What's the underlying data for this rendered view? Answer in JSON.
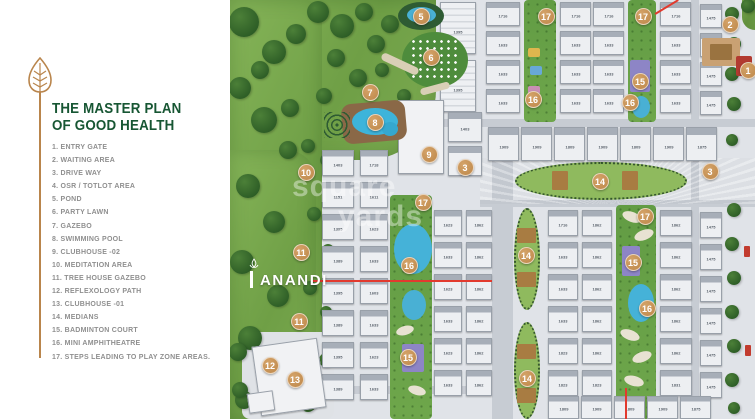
{
  "panel": {
    "title_line1": "THE MASTER PLAN",
    "title_line2": "OF GOOD HEALTH",
    "legend": [
      "1. ENTRY GATE",
      "2. WAITING AREA",
      "3. DRIVE WAY",
      "4. OSR / TOTLOT AREA",
      "5. POND",
      "6. PARTY LAWN",
      "7. GAZEBO",
      "8. SWIMMING POOL",
      "9. CLUBHOUSE -02",
      "10. MEDITATION AREA",
      "11. TREE HOUSE GAZEBO",
      "12. REFLEXOLOGY PATH",
      "13. CLUBHOUSE -01",
      "14.  MEDIANS",
      "15. BADMINTON COURT",
      "16. MINI AMPHITHEATRE",
      "17. STEPS LEADING TO PLAY ZONE AREAS."
    ],
    "title_color": "#175633",
    "accent_gold": "#b9854c"
  },
  "logo": {
    "text": "ANANDI"
  },
  "watermark": {
    "word1": "square",
    "word2": "yards"
  },
  "map": {
    "marker_color": "#c08d55",
    "pavements": [
      {
        "x": 84,
        "y": 0,
        "w": 441,
        "h": 419
      }
    ],
    "roads": [
      {
        "x": 84,
        "y": 119,
        "w": 441,
        "h": 8
      },
      {
        "x": 250,
        "y": 200,
        "w": 275,
        "h": 7
      },
      {
        "x": 262,
        "y": 126,
        "w": 21,
        "h": 293
      },
      {
        "x": 461,
        "y": 0,
        "w": 8,
        "h": 419
      },
      {
        "x": 84,
        "y": 126,
        "w": 8,
        "h": 293
      },
      {
        "x": 84,
        "y": 386,
        "w": 180,
        "h": 8
      },
      {
        "x": 250,
        "y": 158,
        "w": 275,
        "h": 46,
        "rays": true
      }
    ],
    "greens": [
      {
        "x": 0,
        "y": 0,
        "w": 206,
        "h": 160,
        "br": "0 0 70px 10px"
      },
      {
        "x": 0,
        "y": 0,
        "w": 92,
        "h": 419,
        "br": "0 18px 30px 0"
      },
      {
        "x": 0,
        "y": 150,
        "w": 86,
        "h": 269,
        "br": "0 30px 0 0"
      },
      {
        "x": 512,
        "y": 0,
        "w": 13,
        "h": 30,
        "br": "0 0 0 20px"
      }
    ],
    "patches": [
      {
        "x": 12,
        "y": 332,
        "w": 92,
        "h": 87
      }
    ],
    "trees": [
      [
        14,
        22,
        15
      ],
      [
        44,
        52,
        12
      ],
      [
        10,
        88,
        11
      ],
      [
        34,
        120,
        13
      ],
      [
        66,
        34,
        10
      ],
      [
        88,
        12,
        11
      ],
      [
        112,
        26,
        12
      ],
      [
        134,
        12,
        9
      ],
      [
        106,
        58,
        9
      ],
      [
        146,
        44,
        9
      ],
      [
        58,
        150,
        9
      ],
      [
        18,
        186,
        12
      ],
      [
        44,
        222,
        11
      ],
      [
        12,
        262,
        12
      ],
      [
        48,
        296,
        11
      ],
      [
        20,
        338,
        12
      ],
      [
        58,
        372,
        10
      ],
      [
        14,
        400,
        9
      ],
      [
        78,
        404,
        8
      ],
      [
        78,
        146,
        7
      ],
      [
        84,
        214,
        7
      ],
      [
        80,
        288,
        7
      ],
      [
        160,
        24,
        9
      ],
      [
        174,
        96,
        7
      ],
      [
        128,
        78,
        9
      ],
      [
        94,
        96,
        8
      ],
      [
        60,
        108,
        9
      ],
      [
        30,
        70,
        9
      ],
      [
        152,
        70,
        7
      ],
      [
        96,
        160,
        6
      ],
      [
        98,
        250,
        6
      ],
      [
        96,
        312,
        6
      ],
      [
        8,
        352,
        9
      ],
      [
        96,
        360,
        7
      ],
      [
        10,
        390,
        8
      ],
      [
        502,
        14,
        7
      ],
      [
        504,
        44,
        7
      ],
      [
        502,
        74,
        7
      ],
      [
        504,
        104,
        7
      ],
      [
        502,
        140,
        6
      ],
      [
        504,
        210,
        7
      ],
      [
        502,
        244,
        7
      ],
      [
        504,
        278,
        7
      ],
      [
        502,
        312,
        7
      ],
      [
        504,
        346,
        7
      ],
      [
        502,
        380,
        7
      ],
      [
        504,
        408,
        6
      ],
      [
        518,
        6,
        7
      ]
    ],
    "strips": [
      {
        "x": 294,
        "y": 0,
        "w": 32,
        "h": 122
      },
      {
        "x": 398,
        "y": 0,
        "w": 28,
        "h": 122
      },
      {
        "x": 160,
        "y": 195,
        "w": 42,
        "h": 224
      },
      {
        "x": 386,
        "y": 205,
        "w": 40,
        "h": 214
      }
    ],
    "ovals": [
      {
        "x": 285,
        "y": 162,
        "w": 172,
        "h": 38
      },
      {
        "x": 284,
        "y": 208,
        "w": 26,
        "h": 102
      },
      {
        "x": 284,
        "y": 322,
        "w": 26,
        "h": 97
      }
    ],
    "building_columns": [
      {
        "x": 210,
        "w": 36,
        "y0": 2,
        "rowH": 52,
        "gap": 6,
        "labels": [
          "1395",
          "1395"
        ]
      },
      {
        "x": 256,
        "w": 34,
        "y0": 2,
        "rowH": 24,
        "gap": 5,
        "labels": [
          "1716",
          "1633",
          "1633",
          "1633"
        ]
      },
      {
        "x": 330,
        "w": 31,
        "y0": 2,
        "rowH": 24,
        "gap": 5,
        "labels": [
          "1716",
          "1633",
          "1633",
          "1633"
        ]
      },
      {
        "x": 363,
        "w": 31,
        "y0": 2,
        "rowH": 24,
        "gap": 5,
        "labels": [
          "1716",
          "1633",
          "1633",
          "1633"
        ]
      },
      {
        "x": 430,
        "w": 31,
        "y0": 2,
        "rowH": 24,
        "gap": 5,
        "labels": [
          "1716",
          "1633",
          "1633",
          "1633"
        ]
      },
      {
        "x": 470,
        "w": 22,
        "y0": 4,
        "rowH": 24,
        "gap": 5,
        "labels": [
          "1475",
          "1475",
          "1475",
          "1475"
        ]
      },
      {
        "x": 92,
        "w": 32,
        "y0": 150,
        "rowH": 26,
        "gap": 6,
        "labels": [
          "1403",
          "1151",
          "1395",
          "1389",
          "1395",
          "1389",
          "1395",
          "1389"
        ]
      },
      {
        "x": 130,
        "w": 28,
        "y0": 150,
        "rowH": 26,
        "gap": 6,
        "labels": [
          "1718",
          "1611",
          "1623",
          "1633",
          "1603",
          "1633",
          "1623",
          "1633"
        ]
      },
      {
        "x": 204,
        "w": 28,
        "y0": 210,
        "rowH": 26,
        "gap": 6,
        "labels": [
          "1623",
          "1633",
          "1623",
          "1633",
          "1623",
          "1633"
        ]
      },
      {
        "x": 236,
        "w": 26,
        "y0": 210,
        "rowH": 26,
        "gap": 6,
        "labels": [
          "1862",
          "1862",
          "1862",
          "1862",
          "1862",
          "1862"
        ]
      },
      {
        "x": 318,
        "w": 30,
        "y0": 210,
        "rowH": 26,
        "gap": 6,
        "labels": [
          "1716",
          "1633",
          "1633",
          "1633",
          "1823",
          "1823"
        ]
      },
      {
        "x": 352,
        "w": 30,
        "y0": 210,
        "rowH": 26,
        "gap": 6,
        "labels": [
          "1862",
          "1862",
          "1862",
          "1862",
          "1862",
          "1823"
        ]
      },
      {
        "x": 430,
        "w": 32,
        "y0": 210,
        "rowH": 26,
        "gap": 6,
        "labels": [
          "1862",
          "1862",
          "1862",
          "1862",
          "1862",
          "1831"
        ]
      },
      {
        "x": 470,
        "w": 22,
        "y0": 212,
        "rowH": 26,
        "gap": 6,
        "labels": [
          "1475",
          "1475",
          "1475",
          "1475",
          "1475",
          "1475"
        ]
      }
    ],
    "building_rows": [
      {
        "y": 127,
        "h": 34,
        "x0": 258,
        "segW": 31,
        "gap": 2,
        "labels": [
          "1909",
          "1909",
          "1809",
          "1909",
          "1809",
          "1909",
          "1875"
        ]
      },
      {
        "y": 396,
        "h": 23,
        "x0": 318,
        "segW": 31,
        "gap": 2,
        "labels": [
          "1809",
          "1909",
          "1809",
          "1909",
          "1875"
        ]
      }
    ],
    "building_singles": [
      {
        "x": 168,
        "y": 100,
        "w": 46,
        "h": 74,
        "label": "",
        "plain": true
      },
      {
        "x": 218,
        "y": 112,
        "w": 34,
        "h": 30,
        "label": "1403"
      },
      {
        "x": 218,
        "y": 146,
        "w": 34,
        "h": 30,
        "label": "1623"
      },
      {
        "x": 26,
        "y": 342,
        "w": 66,
        "h": 70,
        "label": "",
        "plain": true,
        "rot": -8
      },
      {
        "x": 18,
        "y": 392,
        "w": 26,
        "h": 20,
        "label": "",
        "plain": true,
        "rot": -8
      }
    ],
    "deco": [
      {
        "k": "e",
        "x": 168,
        "y": 2,
        "w": 46,
        "h": 28,
        "c": "#2e5b33"
      },
      {
        "k": "e",
        "x": 177,
        "y": 7,
        "w": 29,
        "h": 16,
        "c": "#49b0d4"
      },
      {
        "k": "e",
        "x": 172,
        "y": 32,
        "w": 66,
        "h": 56,
        "c": "#4e8c3c"
      },
      {
        "k": "dots",
        "x": 180,
        "y": 38,
        "w": 50,
        "h": 44
      },
      {
        "k": "e",
        "x": 133,
        "y": 86,
        "w": 13,
        "h": 11,
        "c": "#7a5a38"
      },
      {
        "k": "r",
        "x": 112,
        "y": 102,
        "w": 64,
        "h": 40,
        "c": "#8a6847",
        "br": 10,
        "rot": -5
      },
      {
        "k": "e",
        "x": 122,
        "y": 108,
        "w": 46,
        "h": 27,
        "c": "#3db4da"
      },
      {
        "k": "e",
        "x": 152,
        "y": 122,
        "w": 16,
        "h": 14,
        "c": "#35a8cf"
      },
      {
        "k": "rings",
        "x": 94,
        "y": 112,
        "w": 26,
        "h": 26
      },
      {
        "k": "r",
        "x": 150,
        "y": 60,
        "w": 40,
        "h": 8,
        "c": "#d9cfb6",
        "br": 6,
        "rot": 25
      },
      {
        "k": "r",
        "x": 190,
        "y": 85,
        "w": 30,
        "h": 7,
        "c": "#d9cfb6",
        "br": 6,
        "rot": -15
      },
      {
        "k": "r",
        "x": 298,
        "y": 48,
        "w": 12,
        "h": 9,
        "c": "#dfb64e",
        "br": 2
      },
      {
        "k": "r",
        "x": 300,
        "y": 66,
        "w": 12,
        "h": 9,
        "c": "#68a8d8",
        "br": 2
      },
      {
        "k": "r",
        "x": 298,
        "y": 86,
        "w": 12,
        "h": 8,
        "c": "#c98fb6",
        "br": 2
      },
      {
        "k": "r",
        "x": 400,
        "y": 60,
        "w": 20,
        "h": 32,
        "c": "#8d85c6",
        "br": 2
      },
      {
        "k": "e",
        "x": 402,
        "y": 96,
        "w": 18,
        "h": 22,
        "c": "#49b0d4"
      },
      {
        "k": "e",
        "x": 164,
        "y": 224,
        "w": 38,
        "h": 50,
        "c": "#45b2d8"
      },
      {
        "k": "e",
        "x": 172,
        "y": 290,
        "w": 24,
        "h": 30,
        "c": "#49b0d4"
      },
      {
        "k": "r",
        "x": 172,
        "y": 344,
        "w": 22,
        "h": 28,
        "c": "#8d85c6",
        "br": 2
      },
      {
        "k": "r",
        "x": 392,
        "y": 246,
        "w": 18,
        "h": 30,
        "c": "#8d85c6",
        "br": 2
      },
      {
        "k": "e",
        "x": 398,
        "y": 284,
        "w": 26,
        "h": 38,
        "c": "#45b2d8"
      },
      {
        "k": "e",
        "x": 392,
        "y": 212,
        "w": 20,
        "h": 10,
        "c": "#e8e2d2",
        "rot": 20
      },
      {
        "k": "e",
        "x": 404,
        "y": 230,
        "w": 20,
        "h": 10,
        "c": "#e8e2d2",
        "rot": -20
      },
      {
        "k": "e",
        "x": 390,
        "y": 330,
        "w": 20,
        "h": 10,
        "c": "#e8e2d2",
        "rot": 20
      },
      {
        "k": "e",
        "x": 402,
        "y": 352,
        "w": 20,
        "h": 10,
        "c": "#e8e2d2",
        "rot": -20
      },
      {
        "k": "e",
        "x": 394,
        "y": 376,
        "w": 20,
        "h": 10,
        "c": "#e8e2d2",
        "rot": 15
      },
      {
        "k": "e",
        "x": 166,
        "y": 326,
        "w": 18,
        "h": 9,
        "c": "#e8e2d2",
        "rot": -15
      },
      {
        "k": "e",
        "x": 178,
        "y": 386,
        "w": 18,
        "h": 9,
        "c": "#e8e2d2",
        "rot": 15
      },
      {
        "k": "r",
        "x": 472,
        "y": 38,
        "w": 38,
        "h": 28,
        "c": "#c9a173",
        "br": 2
      },
      {
        "k": "r",
        "x": 480,
        "y": 44,
        "w": 22,
        "h": 16,
        "c": "#9a7340",
        "br": 1
      },
      {
        "k": "r",
        "x": 506,
        "y": 56,
        "w": 16,
        "h": 20,
        "c": "#b23a30",
        "br": 2
      },
      {
        "k": "r",
        "x": 514,
        "y": 246,
        "w": 6,
        "h": 11,
        "c": "#c23b2e",
        "br": 1
      },
      {
        "k": "r",
        "x": 515,
        "y": 345,
        "w": 6,
        "h": 11,
        "c": "#c23b2e",
        "br": 1
      },
      {
        "k": "r",
        "x": 322,
        "y": 171,
        "w": 16,
        "h": 19,
        "c": "#a87c42",
        "br": 1
      },
      {
        "k": "r",
        "x": 392,
        "y": 171,
        "w": 16,
        "h": 19,
        "c": "#a87c42",
        "br": 1
      },
      {
        "k": "r",
        "x": 287,
        "y": 228,
        "w": 19,
        "h": 15,
        "c": "#a87c42",
        "br": 1
      },
      {
        "k": "r",
        "x": 287,
        "y": 272,
        "w": 19,
        "h": 15,
        "c": "#a87c42",
        "br": 1
      },
      {
        "k": "r",
        "x": 287,
        "y": 344,
        "w": 19,
        "h": 15,
        "c": "#a87c42",
        "br": 1
      },
      {
        "k": "r",
        "x": 287,
        "y": 388,
        "w": 19,
        "h": 15,
        "c": "#a87c42",
        "br": 1
      }
    ],
    "red_lines": [
      {
        "x": 82,
        "y": 280,
        "w": 180,
        "h": 1.5,
        "rot": 0
      },
      {
        "x": 395,
        "y": 388,
        "w": 1.5,
        "h": 31,
        "rot": 0
      },
      {
        "x": 425,
        "y": 13,
        "w": 27,
        "h": 1.5,
        "rot": -31
      }
    ],
    "markers": [
      {
        "n": "1",
        "x": 518,
        "y": 70
      },
      {
        "n": "2",
        "x": 500,
        "y": 24
      },
      {
        "n": "3",
        "x": 235,
        "y": 167
      },
      {
        "n": "3",
        "x": 480,
        "y": 171
      },
      {
        "n": "5",
        "x": 191,
        "y": 16
      },
      {
        "n": "6",
        "x": 201,
        "y": 57
      },
      {
        "n": "7",
        "x": 140,
        "y": 92
      },
      {
        "n": "8",
        "x": 145,
        "y": 122
      },
      {
        "n": "9",
        "x": 199,
        "y": 154
      },
      {
        "n": "10",
        "x": 76,
        "y": 172
      },
      {
        "n": "11",
        "x": 71,
        "y": 252
      },
      {
        "n": "11",
        "x": 69,
        "y": 321
      },
      {
        "n": "12",
        "x": 40,
        "y": 365
      },
      {
        "n": "13",
        "x": 65,
        "y": 379
      },
      {
        "n": "14",
        "x": 370,
        "y": 181
      },
      {
        "n": "14",
        "x": 296,
        "y": 255
      },
      {
        "n": "14",
        "x": 297,
        "y": 378
      },
      {
        "n": "15",
        "x": 410,
        "y": 81
      },
      {
        "n": "15",
        "x": 403,
        "y": 262
      },
      {
        "n": "15",
        "x": 178,
        "y": 357
      },
      {
        "n": "16",
        "x": 303,
        "y": 99
      },
      {
        "n": "16",
        "x": 400,
        "y": 102
      },
      {
        "n": "16",
        "x": 179,
        "y": 265
      },
      {
        "n": "16",
        "x": 417,
        "y": 308
      },
      {
        "n": "17",
        "x": 316,
        "y": 16
      },
      {
        "n": "17",
        "x": 413,
        "y": 16
      },
      {
        "n": "17",
        "x": 193,
        "y": 202
      },
      {
        "n": "17",
        "x": 415,
        "y": 216
      }
    ]
  }
}
